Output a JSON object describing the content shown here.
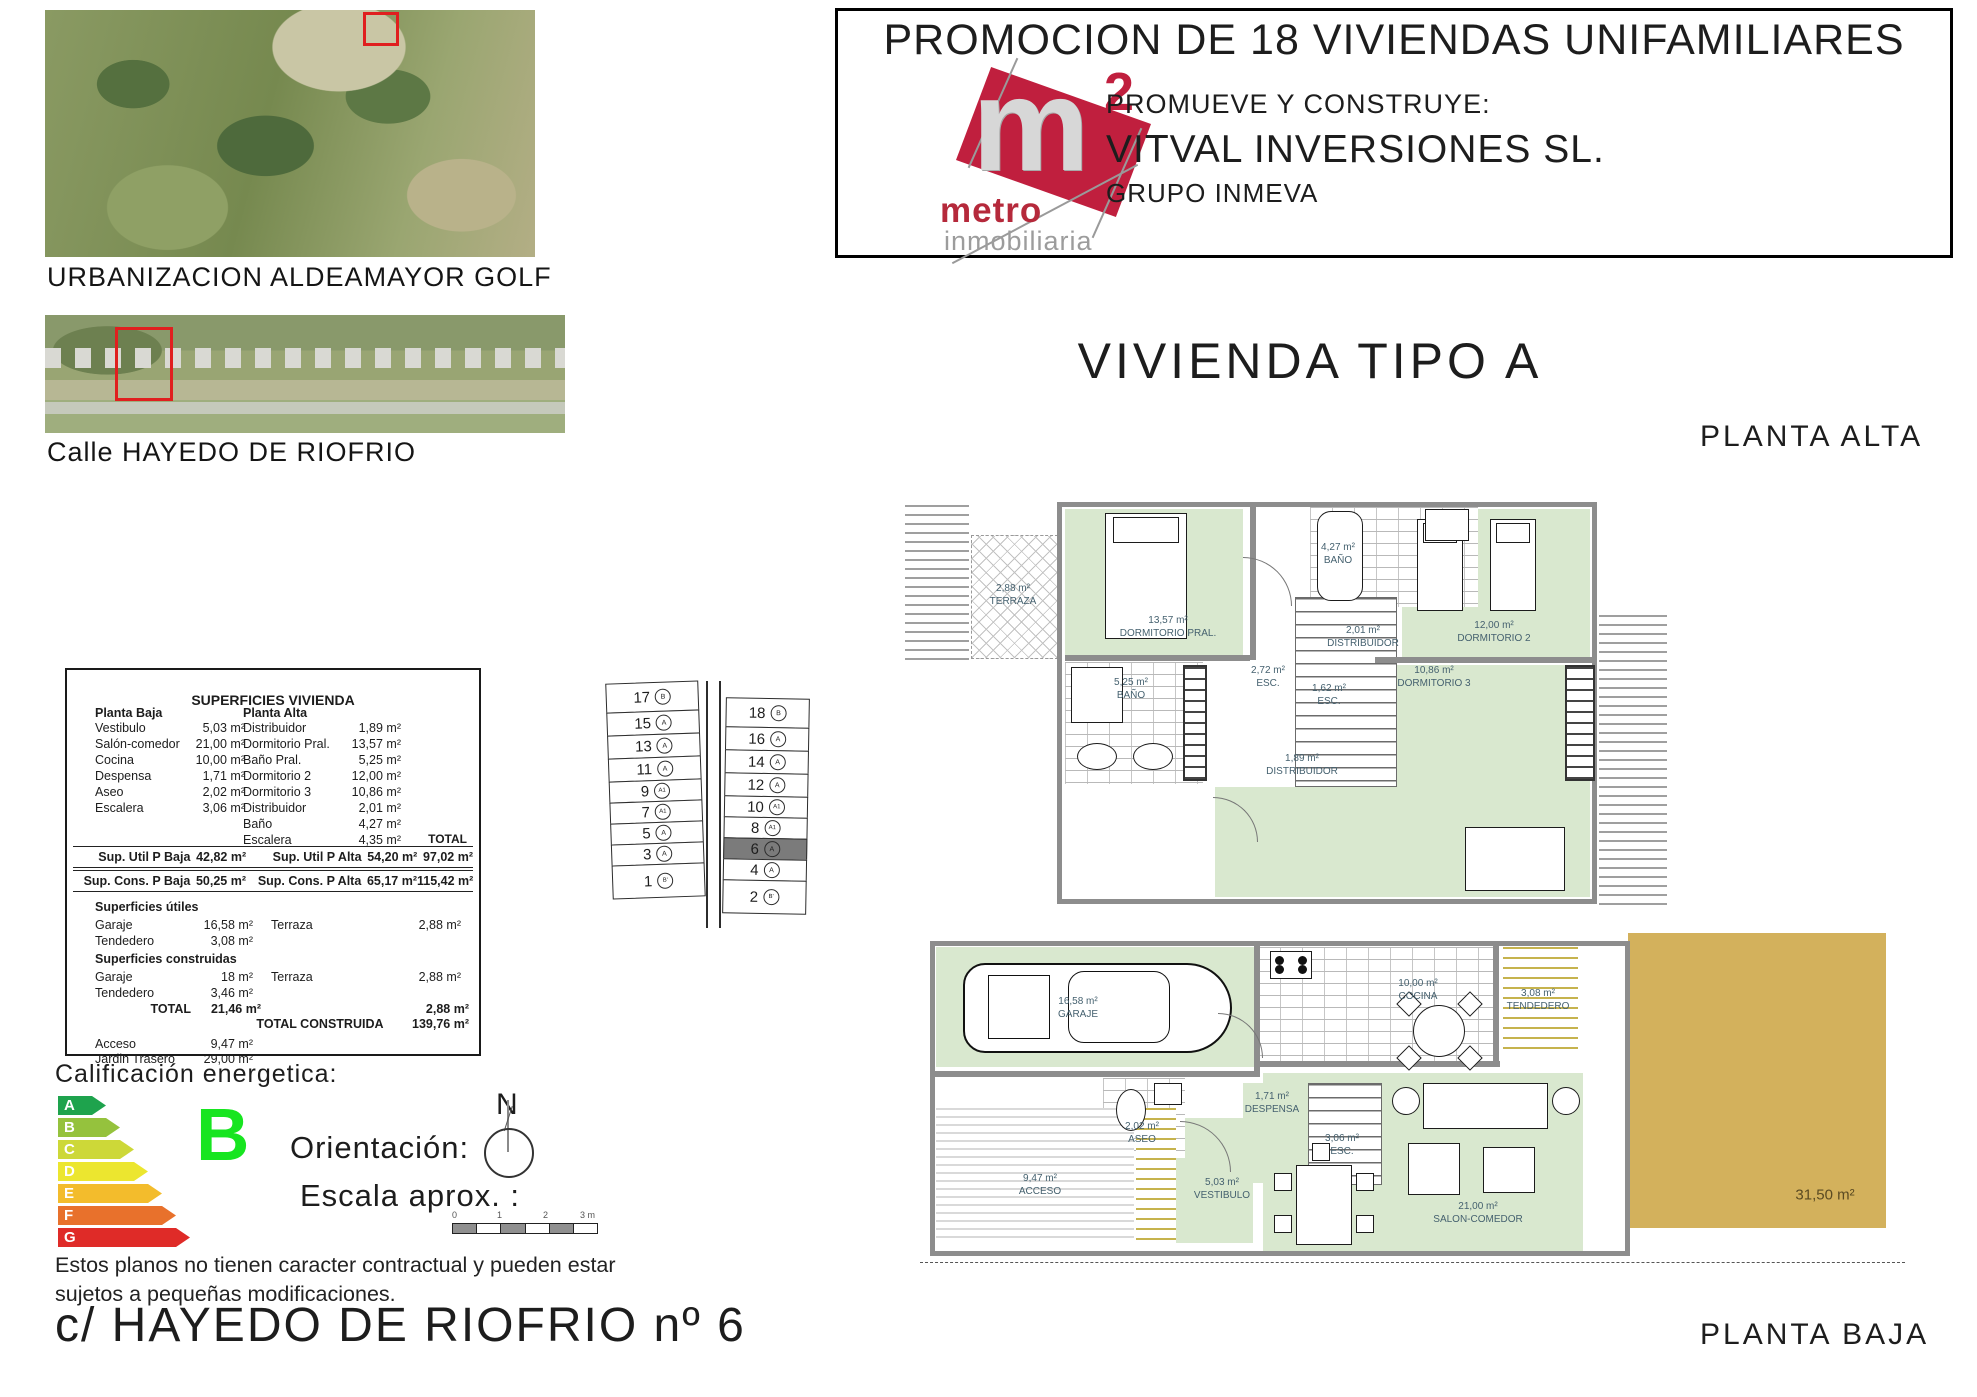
{
  "colors": {
    "logo_red": "#c01f3e",
    "highlight_red": "#e01f1f",
    "room_green": "#d9e8cf",
    "garden_tan": "#d3b15c",
    "wall_gray": "#8d8d8d"
  },
  "header": {
    "title": "PROMOCION DE 18 VIVIENDAS UNIFAMILIARES",
    "logo": {
      "letter": "m",
      "exponent": "2",
      "brand": "metro",
      "tagline": "inmobiliaria"
    },
    "promoter_label": "PROMUEVE Y CONSTRUYE:",
    "promoter_name": "VITVAL INVERSIONES SL.",
    "promoter_group": "GRUPO INMEVA"
  },
  "photos": {
    "photo1_caption": "URBANIZACION ALDEAMAYOR GOLF",
    "photo2_caption": "Calle HAYEDO DE RIOFRIO"
  },
  "vivienda": {
    "title": "VIVIENDA TIPO A",
    "upper_floor_label": "PLANTA ALTA",
    "ground_floor_label": "PLANTA BAJA"
  },
  "surface_table": {
    "title": "SUPERFICIES VIVIENDA",
    "left_header": "Planta Baja",
    "right_header": "Planta Alta",
    "left_rows": [
      {
        "label": "Vestibulo",
        "value": "5,03 m²"
      },
      {
        "label": "Salón-comedor",
        "value": "21,00 m²"
      },
      {
        "label": "Cocina",
        "value": "10,00 m²"
      },
      {
        "label": "Despensa",
        "value": "1,71 m²"
      },
      {
        "label": "Aseo",
        "value": "2,02 m²"
      },
      {
        "label": "Escalera",
        "value": "3,06 m²"
      }
    ],
    "right_rows": [
      {
        "label": "Distribuidor",
        "value": "1,89 m²"
      },
      {
        "label": "Dormitorio Pral.",
        "value": "13,57 m²"
      },
      {
        "label": "Baño Pral.",
        "value": "5,25 m²"
      },
      {
        "label": "Dormitorio 2",
        "value": "12,00 m²"
      },
      {
        "label": "Dormitorio 3",
        "value": "10,86 m²"
      },
      {
        "label": "Distribuidor",
        "value": "2,01 m²"
      },
      {
        "label": "Baño",
        "value": "4,27 m²"
      },
      {
        "label": "Escalera",
        "value": "4,35 m²"
      }
    ],
    "total_header": "TOTAL",
    "util_row": {
      "left_label": "Sup. Util  P Baja",
      "left_value": "42,82 m²",
      "right_label": "Sup. Util  P Alta",
      "right_value": "54,20 m²",
      "total": "97,02 m²"
    },
    "cons_row": {
      "left_label": "Sup. Cons.  P Baja",
      "left_value": "50,25 m²",
      "right_label": "Sup. Cons.  P Alta",
      "right_value": "65,17 m²",
      "total": "115,42 m²"
    },
    "utiles_heading": "Superficies útiles",
    "utiles_rows": [
      {
        "label": "Garaje",
        "value": "16,58 m²",
        "label2": "Terraza",
        "value2": "2,88 m²"
      },
      {
        "label": "Tendedero",
        "value": "3,08 m²",
        "label2": "",
        "value2": ""
      }
    ],
    "construidas_heading": "Superficies construidas",
    "construidas_rows": [
      {
        "label": "Garaje",
        "value": "18 m²",
        "label2": "Terraza",
        "value2": "2,88 m²"
      },
      {
        "label": "Tendedero",
        "value": "3,46 m²",
        "label2": "",
        "value2": ""
      }
    ],
    "total_label": "TOTAL",
    "total_value": "21,46 m²",
    "terraza_total": "2,88 m²",
    "grand_total_label": "TOTAL CONSTRUIDA",
    "grand_total_value": "139,76 m²",
    "extra_rows": [
      {
        "label": "Acceso",
        "value": "9,47 m²"
      },
      {
        "label": "Jardin Trasero",
        "value": "29,00 m²"
      }
    ]
  },
  "site_plan": {
    "left_lots": [
      {
        "number": "17",
        "type": "B"
      },
      {
        "number": "15",
        "type": "A"
      },
      {
        "number": "13",
        "type": "A"
      },
      {
        "number": "11",
        "type": "A"
      },
      {
        "number": "9",
        "type": "A1"
      },
      {
        "number": "7",
        "type": "A1"
      },
      {
        "number": "5",
        "type": "A"
      },
      {
        "number": "3",
        "type": "A"
      },
      {
        "number": "1",
        "type": "B'"
      }
    ],
    "right_lots": [
      {
        "number": "18",
        "type": "B"
      },
      {
        "number": "16",
        "type": "A"
      },
      {
        "number": "14",
        "type": "A"
      },
      {
        "number": "12",
        "type": "A"
      },
      {
        "number": "10",
        "type": "A1"
      },
      {
        "number": "8",
        "type": "A1"
      },
      {
        "number": "6",
        "type": "A",
        "highlighted": true
      },
      {
        "number": "4",
        "type": "A"
      },
      {
        "number": "2",
        "type": "B'"
      }
    ]
  },
  "energy": {
    "label": "Calificación energetica:",
    "bands": [
      {
        "letter": "A",
        "color": "#1ea34d"
      },
      {
        "letter": "B",
        "color": "#95c23d"
      },
      {
        "letter": "C",
        "color": "#cdd838"
      },
      {
        "letter": "D",
        "color": "#ece62f"
      },
      {
        "letter": "E",
        "color": "#f3bc2c"
      },
      {
        "letter": "F",
        "color": "#e8712c"
      },
      {
        "letter": "G",
        "color": "#df2b28"
      }
    ],
    "rating": "B",
    "rating_color": "#17e520"
  },
  "orientation": {
    "label": "Orientación:",
    "scale_label": "Escala aprox. :",
    "north_letter": "N",
    "scale_ticks": [
      "0",
      "1",
      "2",
      "3 m"
    ]
  },
  "disclaimer_line1": "Estos planos no tienen caracter contractual y pueden estar",
  "disclaimer_line2": "sujetos a pequeñas modificaciones.",
  "address": "c/ HAYEDO DE RIOFRIO nº 6",
  "plans": {
    "alta": {
      "labels": [
        {
          "area": "2,88 m²",
          "name": "TERRAZA"
        },
        {
          "area": "13,57 m²",
          "name": "DORMITORIO PRAL."
        },
        {
          "area": "5,25 m²",
          "name": "BAÑO"
        },
        {
          "area": "4,27 m²",
          "name": "BAÑO"
        },
        {
          "area": "2,72 m²",
          "name": "ESC."
        },
        {
          "area": "1,62 m²",
          "name": "ESC."
        },
        {
          "area": "2,01 m²",
          "name": "DISTRIBUIDOR"
        },
        {
          "area": "1,89 m²",
          "name": "DISTRIBUIDOR"
        },
        {
          "area": "12,00 m²",
          "name": "DORMITORIO 2"
        },
        {
          "area": "10,86 m²",
          "name": "DORMITORIO 3"
        }
      ]
    },
    "baja": {
      "labels": [
        {
          "area": "16,58 m²",
          "name": "GARAJE"
        },
        {
          "area": "10,00 m²",
          "name": "COCINA"
        },
        {
          "area": "3,08 m²",
          "name": "TENDEDERO"
        },
        {
          "area": "1,71 m²",
          "name": "DESPENSA"
        },
        {
          "area": "2,02 m²",
          "name": "ASEO"
        },
        {
          "area": "3,06 m²",
          "name": "ESC."
        },
        {
          "area": "9,47 m²",
          "name": "ACCESO"
        },
        {
          "area": "5,03 m²",
          "name": "VESTIBULO"
        },
        {
          "area": "21,00 m²",
          "name": "SALON-COMEDOR"
        }
      ],
      "garden_area": "31,50 m²"
    }
  }
}
